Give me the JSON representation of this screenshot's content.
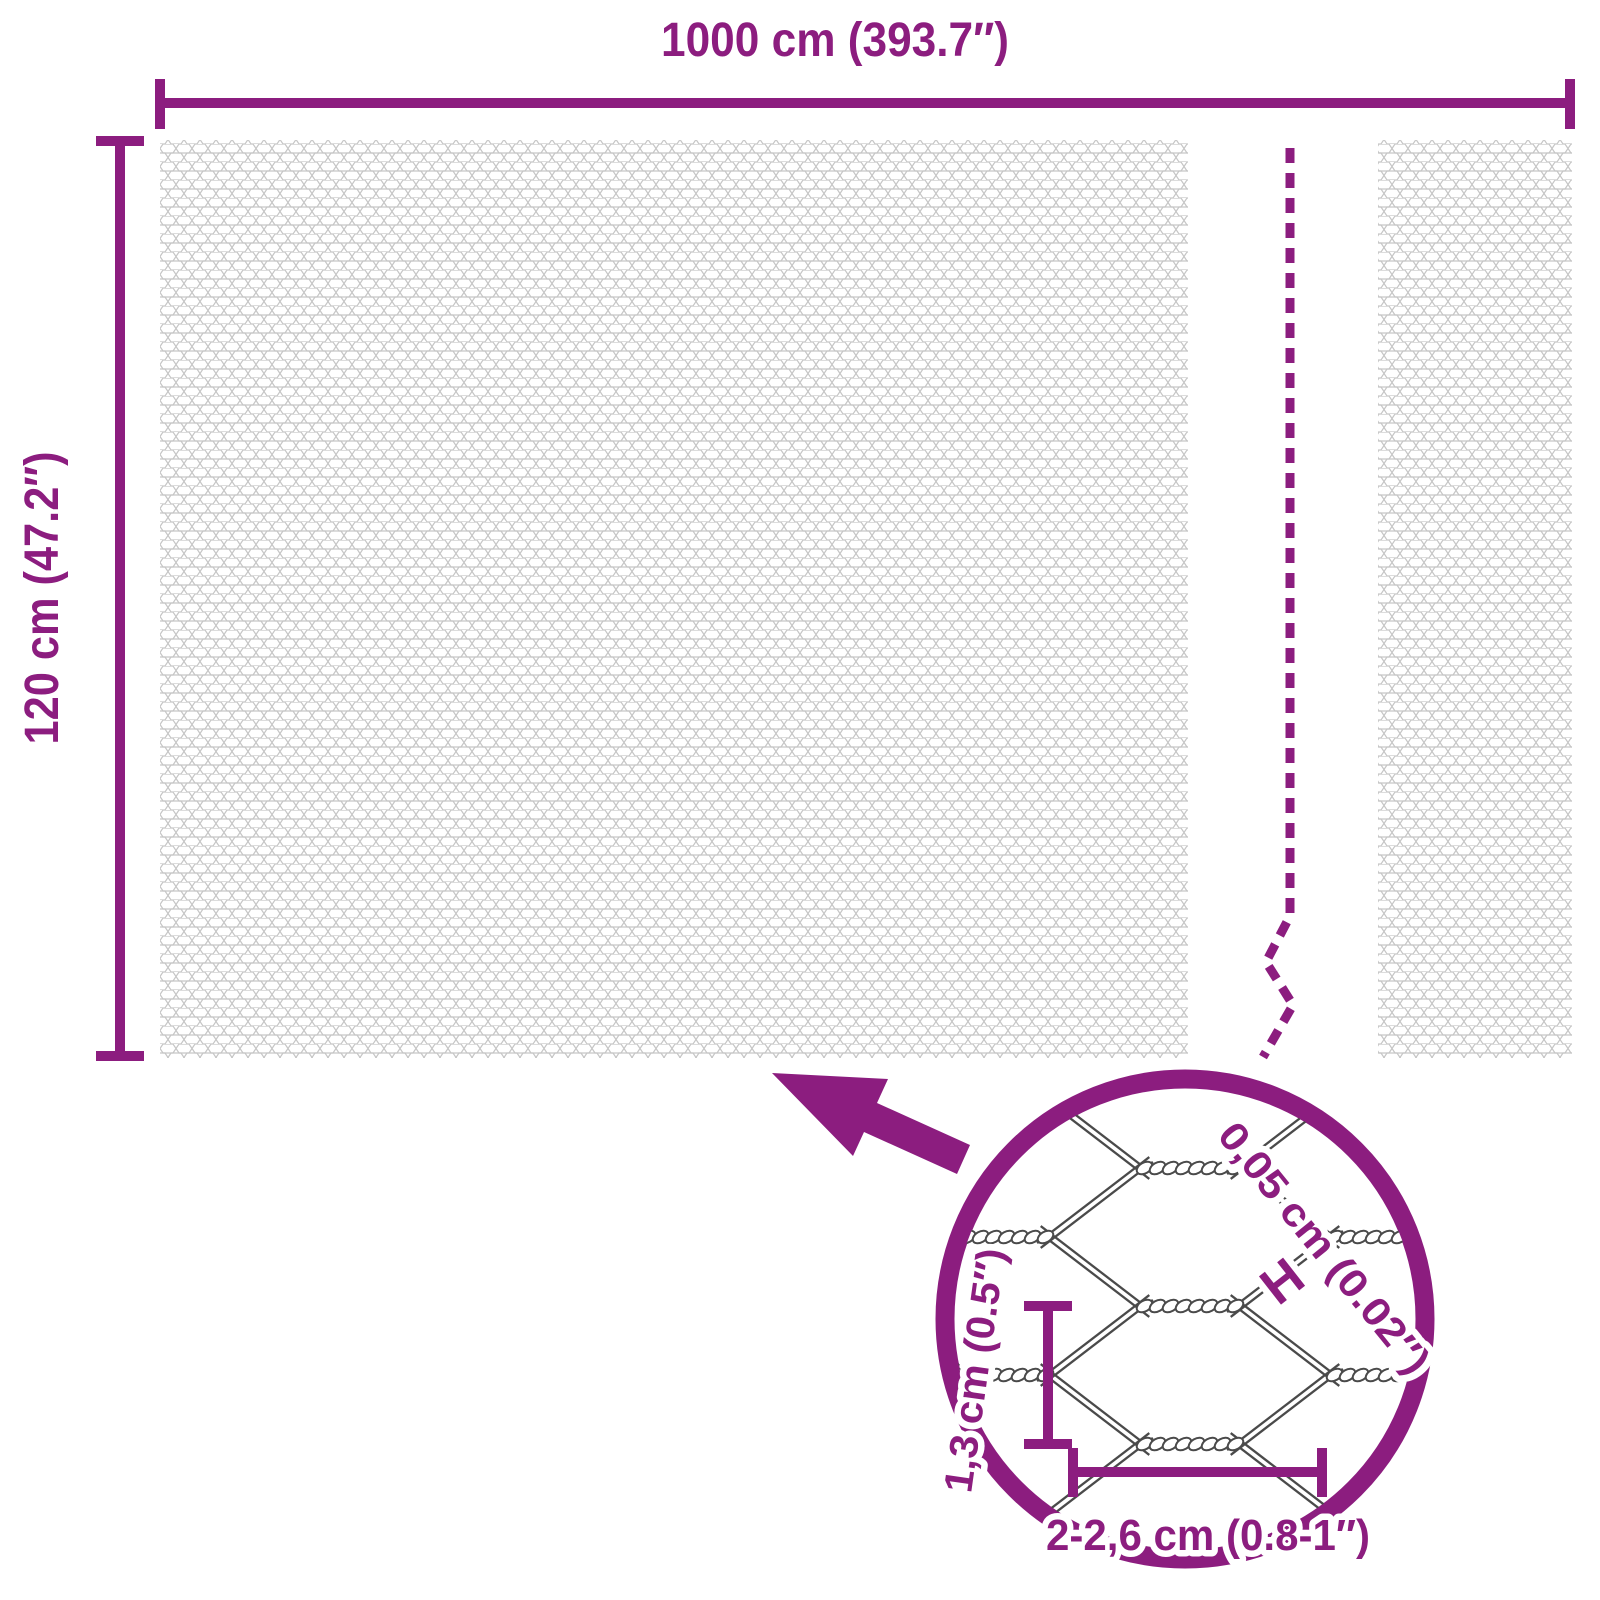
{
  "product_diagram": {
    "overall_width_label": "1000 cm (393.7″)",
    "overall_height_label": "120 cm (47.2″)",
    "detail_view": {
      "wire_thickness_label": "0,05 cm (0.02″)",
      "wire_thickness_marker": "H",
      "mesh_pitch_label": "1,3 cm (0.5″)",
      "mesh_width_label": "2-2,6 cm (0.8-1″)"
    },
    "icons": {
      "zoom_arrow": "arrow-up-left",
      "detail_circle": "magnifier-circle",
      "break_line": "panel-break-dashed"
    },
    "colors": {
      "accent": "#8c1d7f",
      "mesh_line": "#c6c6c6",
      "wire_detail": "#4a4a4a",
      "background": "#ffffff"
    }
  }
}
